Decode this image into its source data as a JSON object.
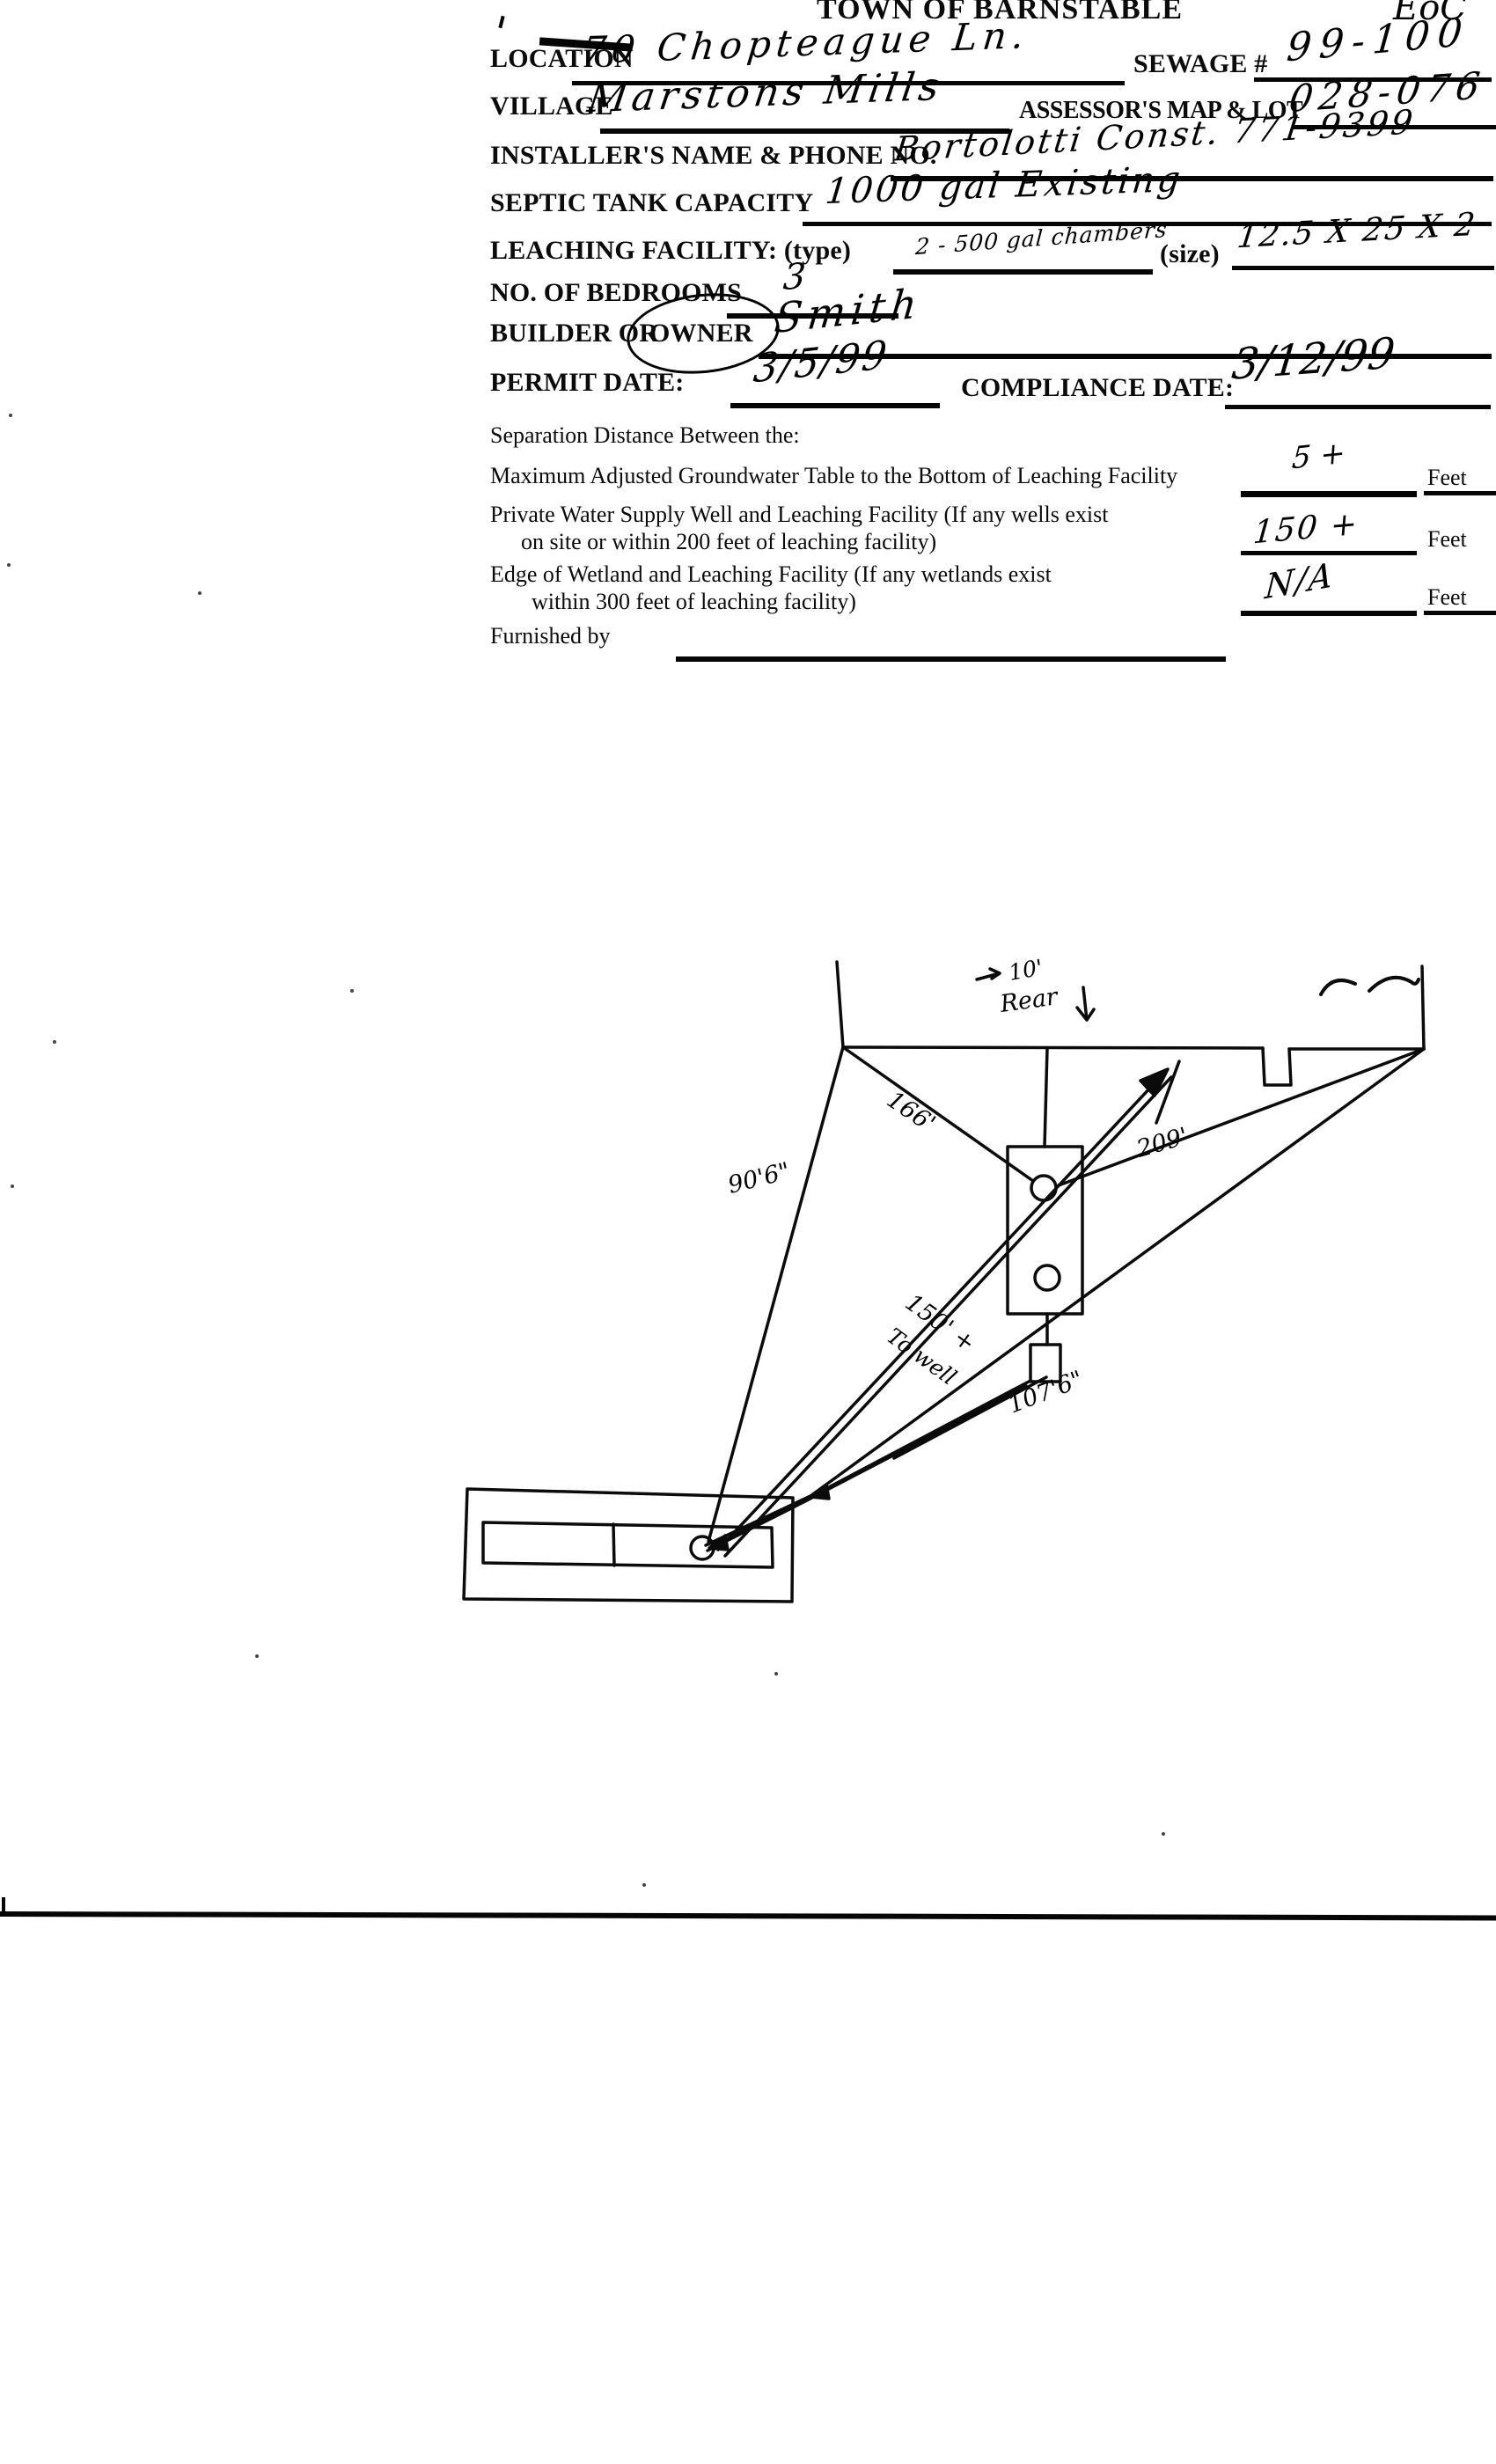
{
  "header": {
    "title": "TOWN OF BARNSTABLE",
    "corner_mark": "EoC"
  },
  "form": {
    "location_label": "LOCATION",
    "location_value": "70 Chopteague Ln.",
    "sewage_label": "SEWAGE #",
    "sewage_value": "99-100",
    "village_label": "VILLAGE",
    "village_value": "Marstons Mills",
    "assessors_label": "ASSESSOR'S MAP & LOT",
    "assessors_value": "028-076",
    "installer_label": "INSTALLER'S NAME & PHONE NO.",
    "installer_value": "Bortolotti Const.  771-9399",
    "septic_label": "SEPTIC TANK CAPACITY",
    "septic_value": "1000 gal  Existing",
    "leaching_label": "LEACHING FACILITY: (type)",
    "leaching_type_value": "2 - 500 gal chambers",
    "size_label": "(size)",
    "size_value": "12.5 X 25 X 2",
    "bedrooms_label": "NO. OF BEDROOMS",
    "bedrooms_value": "3",
    "builder_label": "BUILDER OR",
    "owner_label": "OWNER",
    "builder_value": "Smith",
    "permit_label": "PERMIT DATE:",
    "permit_value": "3/5/99",
    "compliance_label": "COMPLIANCE DATE:",
    "compliance_value": "3/12/99"
  },
  "separation": {
    "heading": "Separation Distance Between the:",
    "groundwater_label": "Maximum Adjusted Groundwater Table to the Bottom of Leaching Facility",
    "groundwater_value": "5 +",
    "well_label_line1": "Private Water Supply Well and Leaching Facility  (If any wells exist",
    "well_label_line2": "on site or within 200 feet of leaching facility)",
    "well_value": "150 +",
    "wetland_label_line1": "Edge of Wetland and Leaching Facility (If any wetlands exist",
    "wetland_label_line2": "within 300 feet of leaching facility)",
    "wetland_value": "N/A",
    "feet_label": "Feet",
    "furnished_label": "Furnished by"
  },
  "sketch": {
    "rear_dim": "10'",
    "rear_label": "Rear",
    "dim_166": "166'",
    "dim_90_6": "90'6\"",
    "dim_209": "209'",
    "dim_150": "150' +",
    "to_well_label": "To well",
    "dim_107_6": "107'6\""
  }
}
